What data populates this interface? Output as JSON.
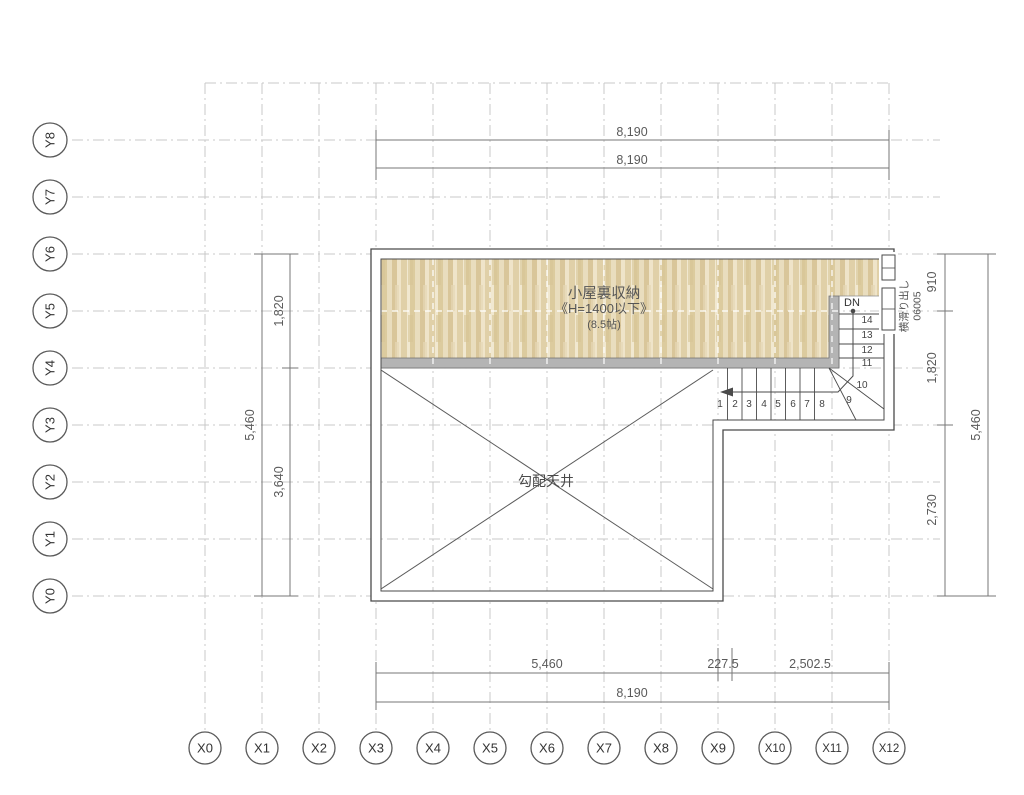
{
  "plan": {
    "room_labels": {
      "attic_name": "小屋裏収納",
      "attic_height": "《H=1400以下》",
      "attic_area": "(8.5帖)",
      "sloped_ceiling": "勾配天井"
    },
    "stairs": {
      "dn": "DN",
      "steps": [
        "1",
        "2",
        "3",
        "4",
        "5",
        "6",
        "7",
        "8",
        "9",
        "10",
        "11",
        "12",
        "13",
        "14"
      ]
    },
    "window": {
      "type": "横滑り出し",
      "size": "06005"
    },
    "dims": {
      "top_row1": "8,190",
      "top_row2": "8,190",
      "bottom_segments": [
        "5,460",
        "227.5",
        "2,502.5"
      ],
      "bottom_overall": "8,190",
      "left_segments": [
        "1,820",
        "3,640"
      ],
      "left_overall": "5,460",
      "right_segments": [
        "910",
        "1,820",
        "2,730"
      ],
      "right_overall": "5,460"
    },
    "grid": {
      "y_labels": [
        "Y8",
        "Y7",
        "Y6",
        "Y5",
        "Y4",
        "Y3",
        "Y2",
        "Y1",
        "Y0"
      ],
      "x_labels": [
        "X0",
        "X1",
        "X2",
        "X3",
        "X4",
        "X5",
        "X6",
        "X7",
        "X8",
        "X9",
        "X10",
        "X11",
        "X12"
      ]
    },
    "colors": {
      "wood_base": "#e5d7b4",
      "wall_gray": "#b4b4b4",
      "line": "#4a4a4a",
      "dim_text": "#5a5a5a",
      "grid_line": "#c9c9c9"
    }
  }
}
